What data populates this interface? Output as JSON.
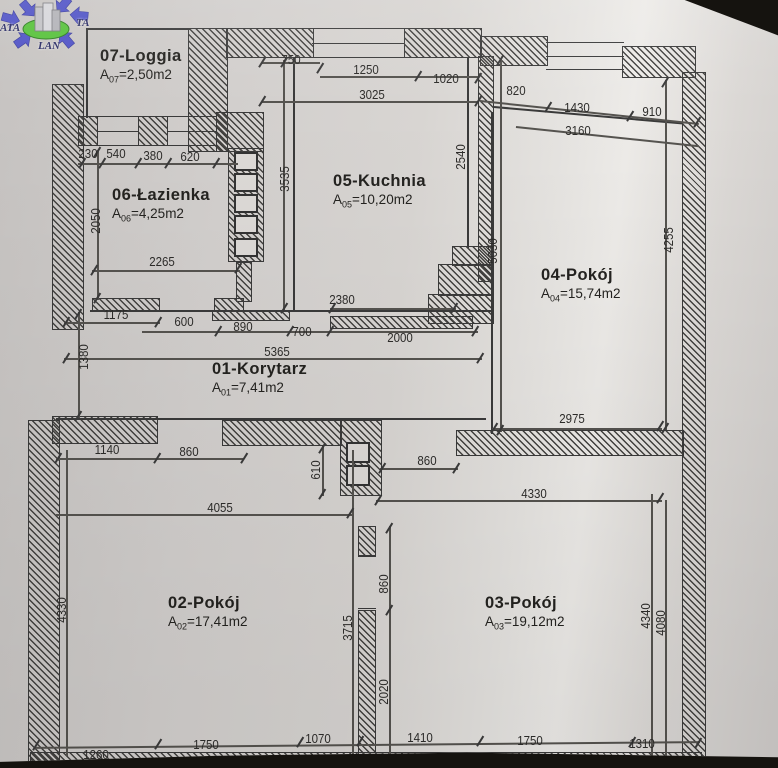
{
  "logo": {
    "left": "ATA",
    "right": "TA",
    "bottom": "LAN"
  },
  "rooms": [
    {
      "name": "07-Loggia",
      "area_prefix": "A",
      "area_sub": "07",
      "area_value": "=2,50m2"
    },
    {
      "name": "06-Łazienka",
      "area_prefix": "A",
      "area_sub": "06",
      "area_value": "=4,25m2"
    },
    {
      "name": "05-Kuchnia",
      "area_prefix": "A",
      "area_sub": "05",
      "area_value": "=10,20m2"
    },
    {
      "name": "04-Pokój",
      "area_prefix": "A",
      "area_sub": "04",
      "area_value": "=15,74m2"
    },
    {
      "name": "01-Korytarz",
      "area_prefix": "A",
      "area_sub": "01",
      "area_value": "=7,41m2"
    },
    {
      "name": "02-Pokój",
      "area_prefix": "A",
      "area_sub": "02",
      "area_value": "=17,41m2"
    },
    {
      "name": "03-Pokój",
      "area_prefix": "A",
      "area_sub": "03",
      "area_value": "=19,12m2"
    }
  ],
  "dims": {
    "top": [
      "750",
      "1250",
      "1020",
      "3025",
      "820",
      "1430",
      "910",
      "3160"
    ],
    "bath_top": [
      "230",
      "540",
      "380",
      "620"
    ],
    "bath": [
      "2050",
      "2265",
      "1175"
    ],
    "kitchen": [
      "3535",
      "2540",
      "5030",
      "2380"
    ],
    "corridor": [
      "600",
      "890",
      "700",
      "2000",
      "5365",
      "1380"
    ],
    "room04": [
      "4255",
      "2975"
    ],
    "middle": [
      "1140",
      "860",
      "610",
      "4055",
      "860",
      "4330"
    ],
    "room02": [
      "4330",
      "3715",
      "860",
      "2020"
    ],
    "room03": [
      "4340",
      "4080"
    ],
    "bottom": [
      "1260",
      "1750",
      "1070",
      "1410",
      "1750",
      "1310"
    ]
  }
}
